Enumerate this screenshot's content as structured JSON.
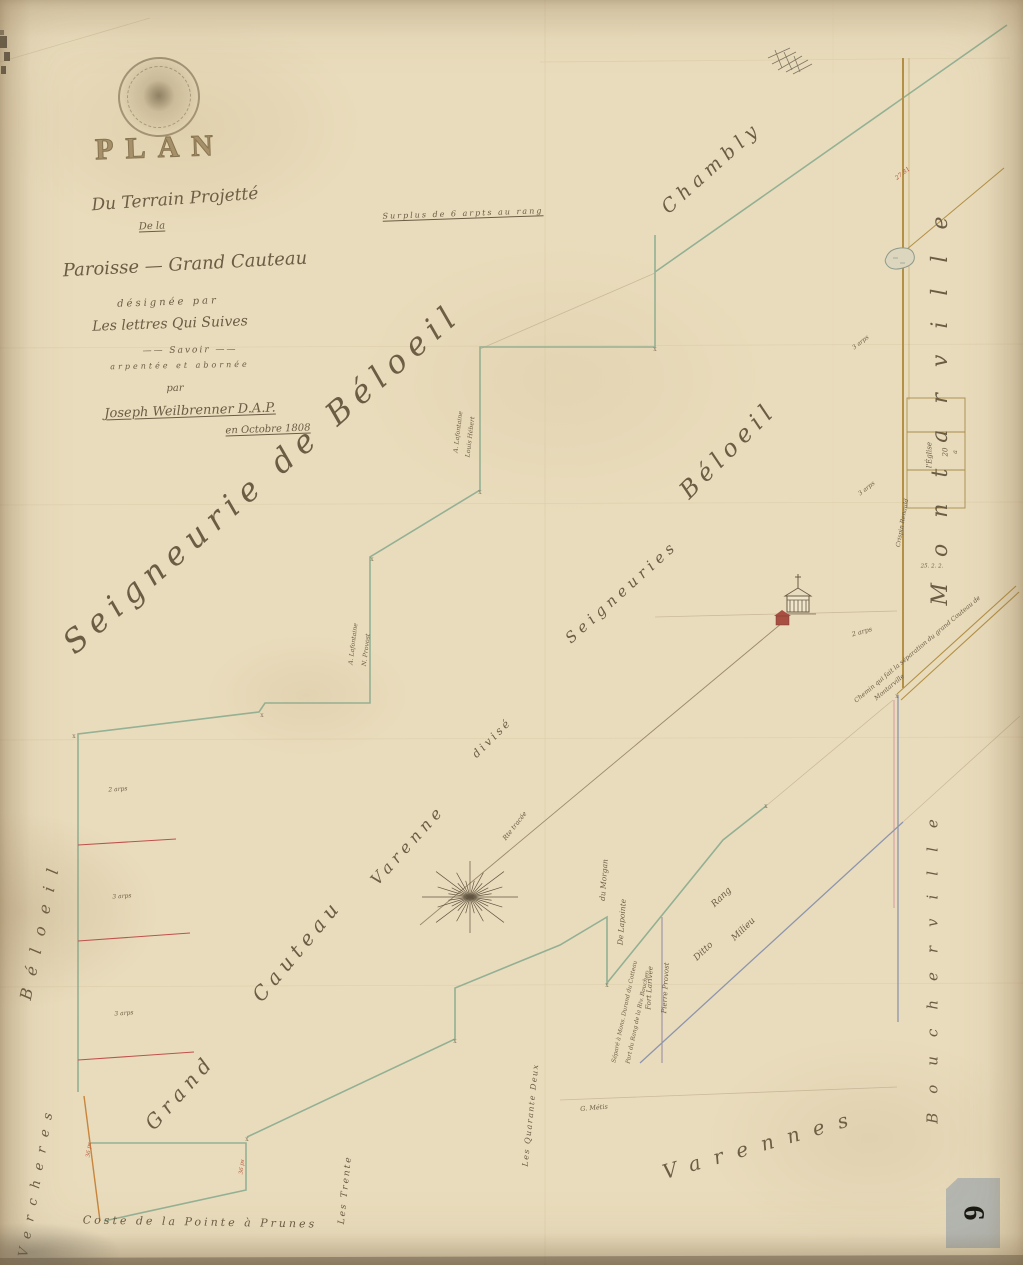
{
  "document": {
    "kind": "manuscript survey plan",
    "language": "French"
  },
  "colors": {
    "paper": "#e9dcbc",
    "boundary_green": "#8fae92",
    "road_brown": "#b39045",
    "line_blue": "#8d94ad",
    "line_pink": "#d898a0",
    "line_purple": "#9a8fa8",
    "line_red": "#c0504d",
    "ink": "#6b5c44",
    "red_label": "#b4583f",
    "sticker_gray": "#b5b8b3"
  },
  "sticker": {
    "number": "6"
  },
  "compass": {
    "x": 470,
    "y": 897,
    "rays": 32,
    "r_long": 48,
    "r_short": 22
  },
  "map_labels": [
    {
      "name": "title-plan",
      "text": "PLAN",
      "x": 160,
      "y": 148,
      "rot": -2,
      "size": 30,
      "sp": 12,
      "cls": "plan"
    },
    {
      "name": "title-line-terrain",
      "text": "Du Terrain Projetté",
      "x": 175,
      "y": 200,
      "rot": -4,
      "size": 17
    },
    {
      "name": "title-line-dela",
      "text": "De la",
      "x": 152,
      "y": 227,
      "rot": -2,
      "size": 10,
      "cls": "u"
    },
    {
      "name": "title-line-paroisse",
      "text": "Paroisse — Grand Cauteau",
      "x": 185,
      "y": 265,
      "rot": -3,
      "size": 18
    },
    {
      "name": "title-line-designee",
      "text": "désignée par",
      "x": 168,
      "y": 303,
      "rot": -2,
      "size": 10,
      "sp": 3
    },
    {
      "name": "title-line-lettres",
      "text": "Les lettres Qui Suives",
      "x": 170,
      "y": 324,
      "rot": -2,
      "size": 14
    },
    {
      "name": "title-line-savoir",
      "text": "—— Savoir ——",
      "x": 190,
      "y": 351,
      "rot": -1,
      "size": 9,
      "sp": 2
    },
    {
      "name": "title-line-arpentee",
      "text": "arpentée  et  abornée",
      "x": 180,
      "y": 366,
      "rot": -1,
      "size": 8,
      "sp": 3
    },
    {
      "name": "title-line-par",
      "text": "par",
      "x": 175,
      "y": 389,
      "rot": -1,
      "size": 10
    },
    {
      "name": "title-signature",
      "text": "Joseph Weilbrenner D.A.P.",
      "x": 190,
      "y": 411,
      "rot": -2,
      "size": 13,
      "cls": "u"
    },
    {
      "name": "title-date",
      "text": "en Octobre 1808",
      "x": 268,
      "y": 430,
      "rot": -2,
      "size": 10,
      "cls": "u"
    },
    {
      "name": "surplus-note",
      "text": "Surplus de 6 arpts au rang",
      "x": 463,
      "y": 214,
      "rot": -2,
      "size": 8,
      "sp": 2,
      "cls": "u"
    },
    {
      "name": "seigneurie-chambly",
      "text": "Chambly",
      "x": 712,
      "y": 168,
      "rot": -42,
      "size": 19,
      "sp": 6
    },
    {
      "name": "seigneurie-de-beloeil",
      "text": "Seigneurie  de  Béloeil",
      "x": 262,
      "y": 478,
      "rot": -41,
      "size": 32,
      "sp": 8
    },
    {
      "name": "label-grand",
      "text": "Grand",
      "x": 180,
      "y": 1092,
      "rot": -48,
      "size": 20,
      "sp": 6
    },
    {
      "name": "label-cauteau",
      "text": "Cauteau",
      "x": 297,
      "y": 950,
      "rot": -50,
      "size": 20,
      "sp": 6
    },
    {
      "name": "label-varenne",
      "text": "Varenne",
      "x": 408,
      "y": 845,
      "rot": -48,
      "size": 16,
      "sp": 5
    },
    {
      "name": "label-divise",
      "text": "divisé",
      "x": 492,
      "y": 738,
      "rot": -45,
      "size": 11,
      "sp": 3
    },
    {
      "name": "label-seigneuries",
      "text": "Seigneuries",
      "x": 622,
      "y": 592,
      "rot": -42,
      "size": 15,
      "sp": 5
    },
    {
      "name": "label-beloeil-diag",
      "text": "Béloeil",
      "x": 728,
      "y": 450,
      "rot": -45,
      "size": 24,
      "sp": 6
    },
    {
      "name": "seigneurie-montarville",
      "text": "Montarville",
      "x": 941,
      "y": 398,
      "rot": -90,
      "size": 22,
      "sp": 26
    },
    {
      "name": "seigneurie-boucherville",
      "text": "Boucherville",
      "x": 933,
      "y": 962,
      "rot": -90,
      "size": 15,
      "sp": 19
    },
    {
      "name": "seigneurie-beloeil-left",
      "text": "Béloeil",
      "x": 41,
      "y": 928,
      "rot": -78,
      "size": 16,
      "sp": 13
    },
    {
      "name": "seigneurie-vercheres",
      "text": "Vercheres",
      "x": 37,
      "y": 1180,
      "rot": -80,
      "size": 13,
      "sp": 10
    },
    {
      "name": "seigneurie-varennes",
      "text": "Varennes",
      "x": 762,
      "y": 1144,
      "rot": -16,
      "size": 20,
      "sp": 14
    },
    {
      "name": "chemin-note-1",
      "text": "Chemin qui fait la séparation du grand Couteau de",
      "x": 918,
      "y": 650,
      "rot": -40,
      "size": 6.3
    },
    {
      "name": "chemin-note-2",
      "text": "Montarville",
      "x": 890,
      "y": 688,
      "rot": -40,
      "size": 6.3
    },
    {
      "name": "rang-label",
      "text": "Rang",
      "x": 722,
      "y": 898,
      "rot": -44,
      "size": 9
    },
    {
      "name": "ditto-label",
      "text": "Ditto",
      "x": 704,
      "y": 952,
      "rot": -44,
      "size": 9
    },
    {
      "name": "milieu-label",
      "text": "Milieu",
      "x": 744,
      "y": 930,
      "rot": -44,
      "size": 9
    },
    {
      "name": "route-note",
      "text": "Rte tracée",
      "x": 515,
      "y": 826,
      "rot": -52,
      "size": 6.5
    },
    {
      "name": "lot-les-trente",
      "text": "Les Trente",
      "x": 346,
      "y": 1190,
      "rot": -84,
      "size": 9,
      "sp": 2
    },
    {
      "name": "lot-les-quarante-deux",
      "text": "Les Quarante Deux",
      "x": 531,
      "y": 1115,
      "rot": -84,
      "size": 8,
      "sp": 1.5
    },
    {
      "name": "owner-du-morgan",
      "text": "du Morgan",
      "x": 604,
      "y": 880,
      "rot": -86,
      "size": 7.5
    },
    {
      "name": "owner-de-lapointe",
      "text": "De Lapointe",
      "x": 622,
      "y": 922,
      "rot": -86,
      "size": 7.5
    },
    {
      "name": "owner-fort-larivee",
      "text": "Fort Larivée",
      "x": 650,
      "y": 988,
      "rot": -87,
      "size": 7
    },
    {
      "name": "owner-pierre-provost",
      "text": "Pierre Provost",
      "x": 666,
      "y": 988,
      "rot": -87,
      "size": 7
    },
    {
      "name": "margin-note-1",
      "text": "Séparé à Mons. Durand du Cotteau",
      "x": 626,
      "y": 1012,
      "rot": -78,
      "size": 5.8
    },
    {
      "name": "margin-note-2",
      "text": "Part du Rang de la Riv. Boucher",
      "x": 639,
      "y": 1018,
      "rot": -78,
      "size": 5.8
    },
    {
      "name": "owner-g-metis",
      "text": "G. Métis",
      "x": 594,
      "y": 1108,
      "rot": -5,
      "size": 6.5
    },
    {
      "name": "owner-lafontaine-1",
      "text": "A. Lafontaine",
      "x": 459,
      "y": 432,
      "rot": -83,
      "size": 6.2
    },
    {
      "name": "owner-louis-hebert",
      "text": "Louis Hébert",
      "x": 471,
      "y": 437,
      "rot": -83,
      "size": 6.2
    },
    {
      "name": "owner-lafontaine-2",
      "text": "A. Lafontaine",
      "x": 354,
      "y": 644,
      "rot": -83,
      "size": 6.2
    },
    {
      "name": "owner-n-provost",
      "text": "N. Provost",
      "x": 367,
      "y": 650,
      "rot": -83,
      "size": 6.2
    },
    {
      "name": "owner-crispin-renauld",
      "text": "Crispin Renauld",
      "x": 903,
      "y": 523,
      "rot": -80,
      "size": 6
    },
    {
      "name": "table-row-eglise",
      "text": "l'Église",
      "x": 930,
      "y": 455,
      "rot": -90,
      "size": 7
    },
    {
      "name": "table-row-20",
      "text": "20",
      "x": 946,
      "y": 452,
      "rot": -90,
      "size": 7
    },
    {
      "name": "table-row-a",
      "text": "a",
      "x": 956,
      "y": 452,
      "rot": -90,
      "size": 6
    },
    {
      "name": "measure-25-2-2",
      "text": "25. 2. 2.",
      "x": 932,
      "y": 567,
      "rot": 0,
      "size": 5.5
    },
    {
      "name": "measure-27-81",
      "text": "27.81",
      "x": 903,
      "y": 174,
      "rot": -38,
      "size": 6,
      "color": "#b4583f"
    },
    {
      "name": "measure-3-arps-1",
      "text": "3 arps",
      "x": 861,
      "y": 343,
      "rot": -38,
      "size": 6
    },
    {
      "name": "measure-3-arps-2",
      "text": "3 arps",
      "x": 867,
      "y": 489,
      "rot": -38,
      "size": 6
    },
    {
      "name": "measure-2-arps-church",
      "text": "2 arps",
      "x": 862,
      "y": 632,
      "rot": -16,
      "size": 6.5
    },
    {
      "name": "measure-2-arps-left",
      "text": "2 arps",
      "x": 118,
      "y": 790,
      "rot": -4,
      "size": 6
    },
    {
      "name": "measure-3-arps-left1",
      "text": "3 arps",
      "x": 122,
      "y": 897,
      "rot": -4,
      "size": 6
    },
    {
      "name": "measure-3-arps-left2",
      "text": "3 arps",
      "x": 124,
      "y": 1014,
      "rot": -4,
      "size": 6
    },
    {
      "name": "measure-36-ps-1",
      "text": "36 ps",
      "x": 90,
      "y": 1150,
      "rot": -84,
      "size": 5.5,
      "color": "#b4583f"
    },
    {
      "name": "measure-36-ps-2",
      "text": "36 ps",
      "x": 243,
      "y": 1167,
      "rot": -84,
      "size": 5.5,
      "color": "#b4583f"
    },
    {
      "name": "caption-coste",
      "text": "Coste  de la  Pointe  à  Prunes",
      "x": 200,
      "y": 1222,
      "rot": 1,
      "size": 11,
      "sp": 3
    },
    {
      "name": "corner-mark",
      "text": "x",
      "x": 655,
      "y": 350,
      "rot": 0,
      "size": 6,
      "cls": "mk"
    },
    {
      "name": "corner-mark",
      "text": "x",
      "x": 480,
      "y": 493,
      "rot": 0,
      "size": 6,
      "cls": "mk"
    },
    {
      "name": "corner-mark",
      "text": "x",
      "x": 372,
      "y": 560,
      "rot": 0,
      "size": 6,
      "cls": "mk"
    },
    {
      "name": "corner-mark",
      "text": "x",
      "x": 262,
      "y": 716,
      "rot": 0,
      "size": 6,
      "cls": "mk"
    },
    {
      "name": "corner-mark",
      "text": "x",
      "x": 74,
      "y": 737,
      "rot": 0,
      "size": 6,
      "cls": "mk"
    },
    {
      "name": "corner-mark",
      "text": "x",
      "x": 455,
      "y": 1042,
      "rot": 0,
      "size": 6,
      "cls": "mk"
    },
    {
      "name": "corner-mark",
      "text": "x",
      "x": 607,
      "y": 986,
      "rot": 0,
      "size": 6,
      "cls": "mk"
    },
    {
      "name": "corner-mark",
      "text": "x",
      "x": 247,
      "y": 1140,
      "rot": 0,
      "size": 6,
      "cls": "mk"
    },
    {
      "name": "corner-mark",
      "text": "x",
      "x": 897,
      "y": 697,
      "rot": 0,
      "size": 6,
      "cls": "mk"
    },
    {
      "name": "corner-mark",
      "text": "x",
      "x": 766,
      "y": 807,
      "rot": 0,
      "size": 6,
      "cls": "mk"
    }
  ]
}
